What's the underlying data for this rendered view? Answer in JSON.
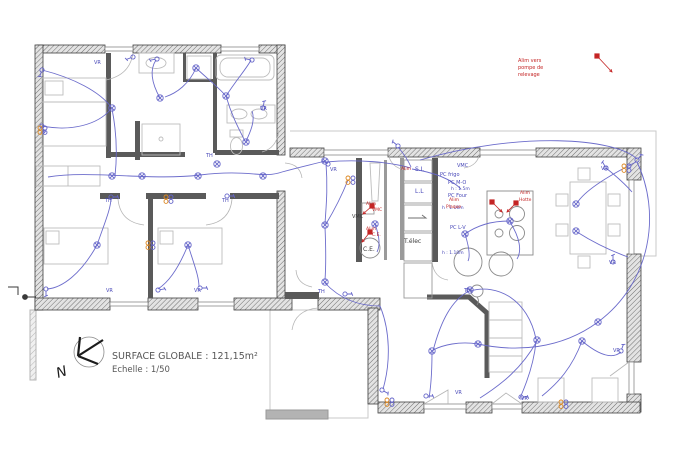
{
  "title": {
    "surface": "SURFACE GLOBALE : 121,15m²",
    "scale": "Echelle : 1/50",
    "north": "N"
  },
  "colors": {
    "blue": "#4848b8",
    "wire": "#6565c9",
    "red": "#c42424",
    "black": "#3a3a3a",
    "orange": "#dd8822",
    "wall": "#3f3f3f",
    "furniture": "#bdbdbd"
  },
  "note_pump": [
    "Alim vers",
    "pompe de",
    "relevage"
  ],
  "labels": [
    {
      "t": "Alim vers",
      "x": 518,
      "y": 62,
      "c": "red",
      "s": 5
    },
    {
      "t": "pompe de",
      "x": 518,
      "y": 69,
      "c": "red",
      "s": 5
    },
    {
      "t": "relevage",
      "x": 518,
      "y": 76,
      "c": "red",
      "s": 5
    },
    {
      "t": "VR",
      "x": 94,
      "y": 64,
      "c": "blue",
      "s": 5
    },
    {
      "t": "VR",
      "x": 260,
      "y": 110,
      "c": "blue",
      "s": 5
    },
    {
      "t": "TH",
      "x": 206,
      "y": 157,
      "c": "blue",
      "s": 5
    },
    {
      "t": "TH",
      "x": 105,
      "y": 202,
      "c": "blue",
      "s": 5
    },
    {
      "t": "TH",
      "x": 222,
      "y": 202,
      "c": "blue",
      "s": 5
    },
    {
      "t": "VR",
      "x": 106,
      "y": 292,
      "c": "blue",
      "s": 5
    },
    {
      "t": "VR",
      "x": 194,
      "y": 292,
      "c": "blue",
      "s": 5
    },
    {
      "t": "VR",
      "x": 330,
      "y": 171,
      "c": "blue",
      "s": 5
    },
    {
      "t": "TH",
      "x": 318,
      "y": 293,
      "c": "blue",
      "s": 5
    },
    {
      "t": "TH",
      "x": 464,
      "y": 292,
      "c": "blue",
      "s": 5
    },
    {
      "t": "VR",
      "x": 601,
      "y": 170,
      "c": "blue",
      "s": 5
    },
    {
      "t": "VR",
      "x": 609,
      "y": 264,
      "c": "blue",
      "s": 5
    },
    {
      "t": "VR",
      "x": 613,
      "y": 352,
      "c": "blue",
      "s": 5
    },
    {
      "t": "VR",
      "x": 455,
      "y": 394,
      "c": "blue",
      "s": 5
    },
    {
      "t": "VR",
      "x": 521,
      "y": 400,
      "c": "blue",
      "s": 5
    },
    {
      "t": "Alim",
      "x": 401,
      "y": 170,
      "c": "red",
      "s": 4.5
    },
    {
      "t": "S.L",
      "x": 415,
      "y": 171,
      "c": "blue",
      "s": 6
    },
    {
      "t": "L.L",
      "x": 415,
      "y": 193,
      "c": "blue",
      "s": 6
    },
    {
      "t": "VMC",
      "x": 457,
      "y": 167,
      "c": "blue",
      "s": 5
    },
    {
      "t": "PC frigo",
      "x": 440,
      "y": 176,
      "c": "blue",
      "s": 5
    },
    {
      "t": "PC M-O",
      "x": 448,
      "y": 184,
      "c": "blue",
      "s": 5
    },
    {
      "t": "h : 1.5m",
      "x": 451,
      "y": 190,
      "c": "blue",
      "s": 4.5
    },
    {
      "t": "PC Four",
      "x": 448,
      "y": 197,
      "c": "blue",
      "s": 5
    },
    {
      "t": "h : 1.10m",
      "x": 442,
      "y": 209,
      "c": "blue",
      "s": 4.5
    },
    {
      "t": "PC L-V",
      "x": 450,
      "y": 229,
      "c": "blue",
      "s": 5
    },
    {
      "t": "h : 1.10m",
      "x": 442,
      "y": 254,
      "c": "blue",
      "s": 4.5
    },
    {
      "t": "Alim",
      "x": 366,
      "y": 205,
      "c": "red",
      "s": 4.5
    },
    {
      "t": "VMC",
      "x": 372,
      "y": 211,
      "c": "red",
      "s": 4.5
    },
    {
      "t": "VMC",
      "x": 352,
      "y": 218,
      "c": "black",
      "s": 5
    },
    {
      "t": "Alim",
      "x": 366,
      "y": 230,
      "c": "red",
      "s": 4.5
    },
    {
      "t": "C.E.",
      "x": 372,
      "y": 236,
      "c": "red",
      "s": 4.5
    },
    {
      "t": "C.E.",
      "x": 363,
      "y": 251,
      "c": "black",
      "s": 6
    },
    {
      "t": "T.élec",
      "x": 404,
      "y": 243,
      "c": "black",
      "s": 6
    },
    {
      "t": "Alim",
      "x": 449,
      "y": 201,
      "c": "red",
      "s": 4.5
    },
    {
      "t": "Plaque",
      "x": 446,
      "y": 208,
      "c": "red",
      "s": 4.5
    },
    {
      "t": "Alim",
      "x": 520,
      "y": 194,
      "c": "red",
      "s": 4.5
    },
    {
      "t": "Hotte",
      "x": 519,
      "y": 201,
      "c": "red",
      "s": 4.5
    }
  ],
  "lights": [
    [
      112,
      108
    ],
    [
      160,
      98
    ],
    [
      196,
      68
    ],
    [
      226,
      96
    ],
    [
      246,
      142
    ],
    [
      112,
      176
    ],
    [
      142,
      176
    ],
    [
      198,
      176
    ],
    [
      263,
      176
    ],
    [
      217,
      164
    ],
    [
      97,
      245
    ],
    [
      188,
      245
    ],
    [
      325,
      161
    ],
    [
      325,
      225
    ],
    [
      325,
      282
    ],
    [
      375,
      224
    ],
    [
      465,
      234
    ],
    [
      510,
      221
    ],
    [
      432,
      351
    ],
    [
      478,
      344
    ],
    [
      537,
      340
    ],
    [
      582,
      341
    ],
    [
      470,
      290
    ],
    [
      576,
      204
    ],
    [
      576,
      231
    ],
    [
      598,
      322
    ]
  ],
  "switches": [
    [
      42,
      70,
      200
    ],
    [
      42,
      126,
      160
    ],
    [
      133,
      57,
      250
    ],
    [
      157,
      59,
      260
    ],
    [
      252,
      60,
      280
    ],
    [
      263,
      108,
      10
    ],
    [
      46,
      289,
      180
    ],
    [
      158,
      290,
      80
    ],
    [
      200,
      288,
      90
    ],
    [
      111,
      197,
      90
    ],
    [
      227,
      196,
      90
    ],
    [
      328,
      164,
      300
    ],
    [
      345,
      294,
      90
    ],
    [
      382,
      390,
      120
    ],
    [
      398,
      146,
      310
    ],
    [
      426,
      396,
      90
    ],
    [
      521,
      397,
      90
    ],
    [
      621,
      351,
      20
    ],
    [
      606,
      168,
      330
    ],
    [
      613,
      262,
      0
    ],
    [
      637,
      160,
      40
    ]
  ],
  "sockets": [
    [
      40,
      128
    ],
    [
      148,
      243
    ],
    [
      166,
      197
    ],
    [
      348,
      178
    ],
    [
      387,
      400
    ],
    [
      561,
      402
    ],
    [
      624,
      166
    ]
  ],
  "red_arrows": [
    {
      "x": 597,
      "y": 56,
      "x2": 612,
      "y2": 72
    },
    {
      "x": 372,
      "y": 206,
      "x2": 363,
      "y2": 214
    },
    {
      "x": 370,
      "y": 232,
      "x2": 362,
      "y2": 242
    },
    {
      "x": 492,
      "y": 202,
      "x2": 502,
      "y2": 212
    },
    {
      "x": 516,
      "y": 203,
      "x2": 507,
      "y2": 212
    }
  ]
}
